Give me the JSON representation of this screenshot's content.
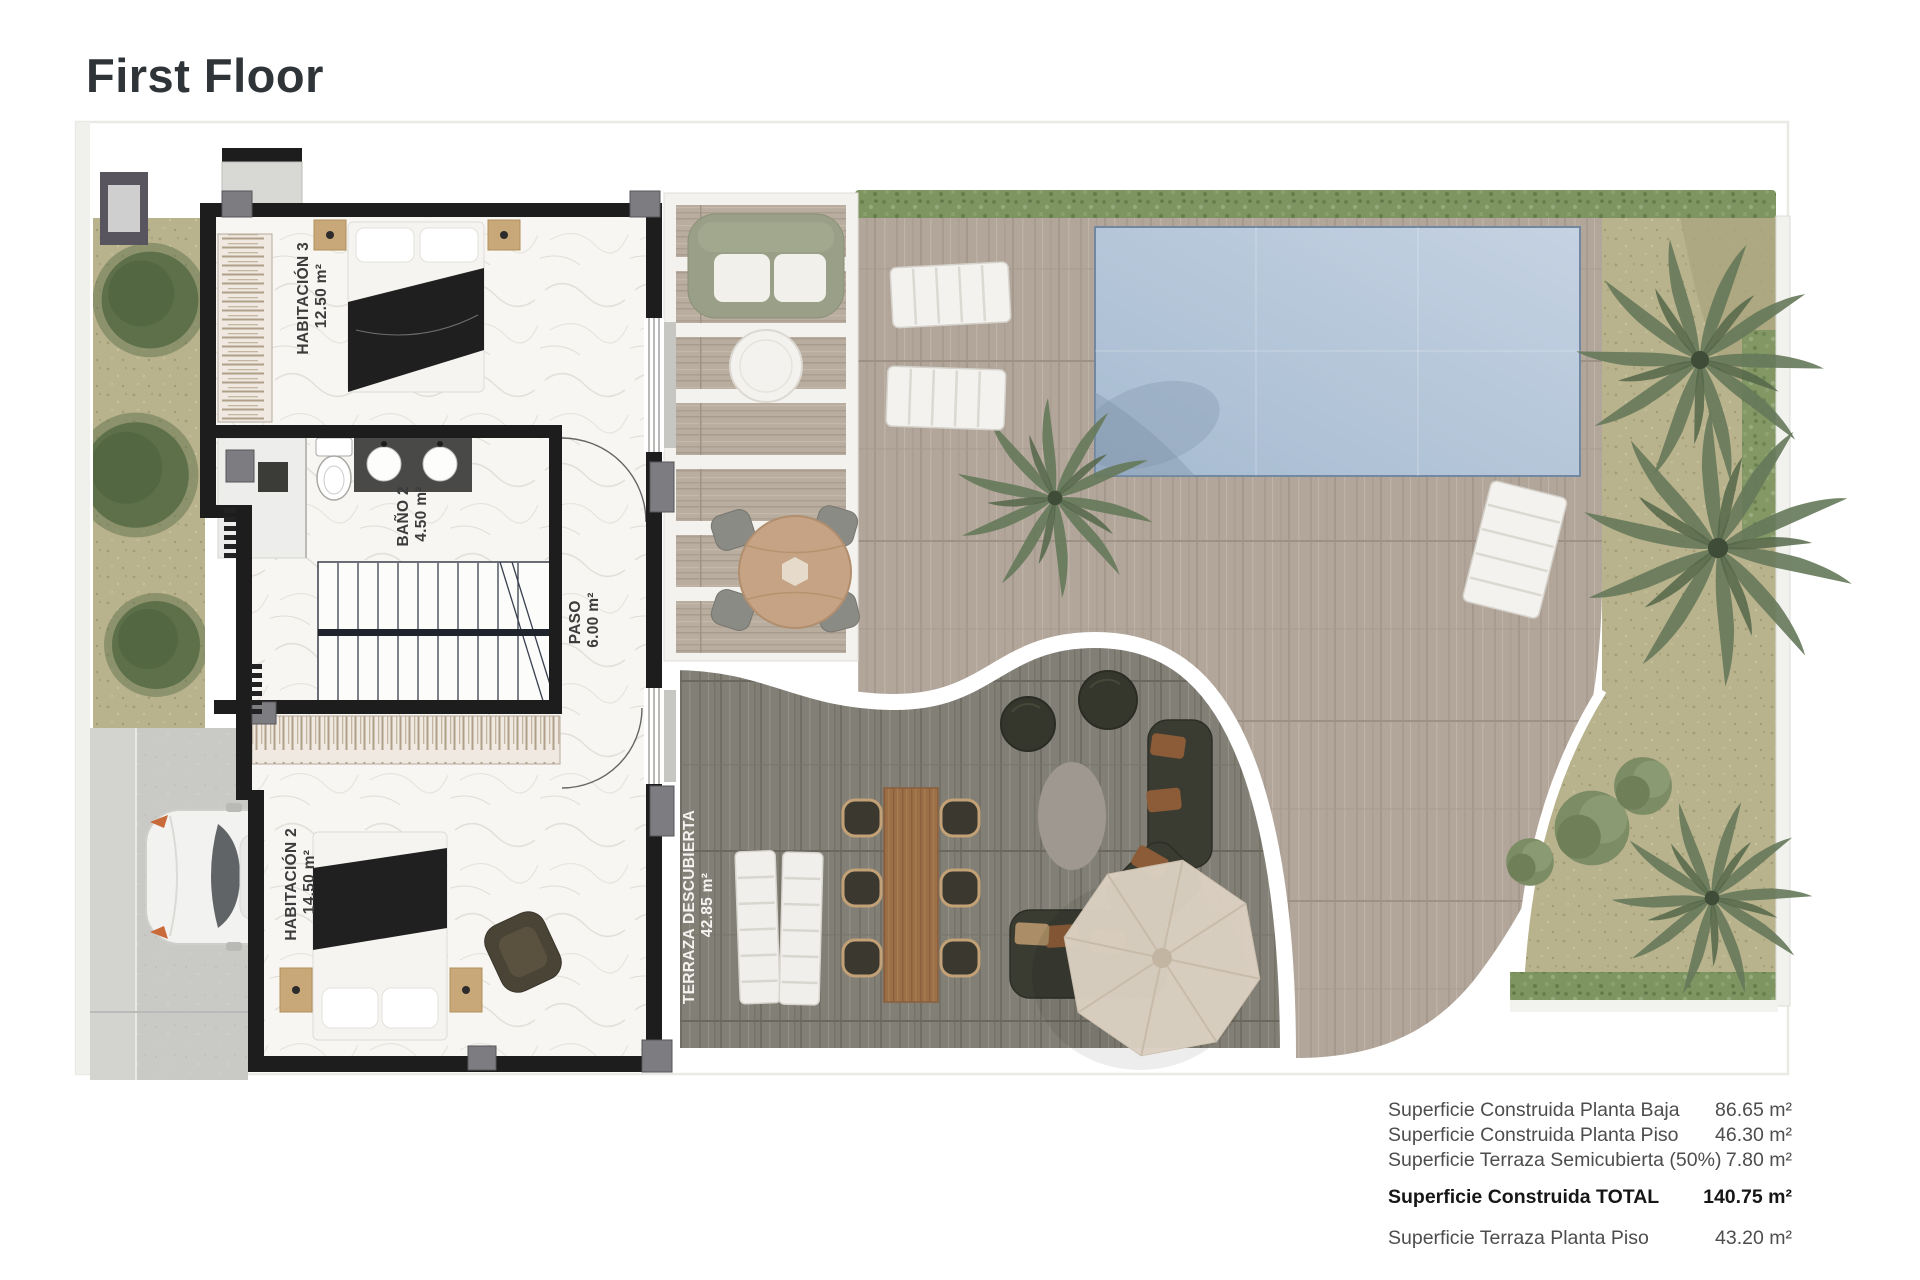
{
  "page": {
    "title": "First Floor"
  },
  "plan": {
    "rooms": [
      {
        "name": "HABITACIÓN 3",
        "area": "12.50 m²"
      },
      {
        "name": "BAÑO 2",
        "area": "4.50 m²"
      },
      {
        "name": "PASO",
        "area": "6.00 m²"
      },
      {
        "name": "HABITACIÓN 2",
        "area": "14.50 m²"
      },
      {
        "name": "TERRAZA DESCUBIERTA",
        "area": "42.85 m²"
      }
    ]
  },
  "areas_table": {
    "rows": [
      {
        "label": "Superficie Construida Planta Baja",
        "value": "86.65 m²"
      },
      {
        "label": "Superficie Construida Planta Piso",
        "value": "46.30 m²"
      },
      {
        "label": "Superficie Terraza Semicubierta (50%)",
        "value": "7.80 m²"
      },
      {
        "label": "Superficie Construida TOTAL",
        "value": "140.75 m²"
      },
      {
        "label": "Superficie Terraza Planta Piso",
        "value": "43.20 m²"
      }
    ]
  },
  "colors": {
    "title_text": "#2f3438",
    "walls": "#1d1d1d",
    "pool": "#b9c8da",
    "light_deck": "#b2a69b",
    "dark_deck": "#827f76",
    "garden": "#b8b28d",
    "hedge": "#7e9562",
    "umbrella": "#dbd0c2"
  }
}
